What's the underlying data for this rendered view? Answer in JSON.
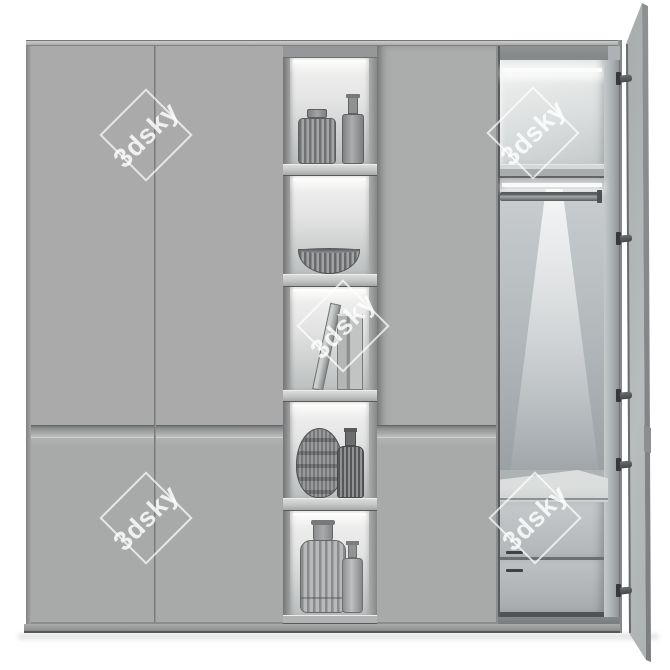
{
  "watermarks": [
    {
      "text": "3dsky",
      "cx": 146,
      "cy": 135
    },
    {
      "text": "3dsky",
      "cx": 533,
      "cy": 133
    },
    {
      "text": "3dsky",
      "cx": 343,
      "cy": 326
    },
    {
      "text": "3dsky",
      "cx": 146,
      "cy": 518
    },
    {
      "text": "3dsky",
      "cx": 535,
      "cy": 518
    }
  ],
  "colors": {
    "background": "#ffffff",
    "door_grey": "#a9aaa9",
    "frame_grey": "#8f9091",
    "niche_highlight": "#f1f1f0",
    "interior_grey": "#b6bbbe",
    "dark_edge": "#57595a",
    "led_white": "#fcfcfb",
    "watermark_white": "rgba(255,255,255,0.8)"
  },
  "scene": {
    "type": "3d-render-preview",
    "subject": "grey wardrobe with open display shelves and open hinged door",
    "left_side": [
      "two plain door panels",
      "horizontal handle groove",
      "base plinth"
    ],
    "shelf_column_objects": [
      "ribbed jar with lid and bottle",
      "ribbed bowl",
      "leaning book and standing books",
      "striped round vase and ribbed bottle",
      "large ribbed bottle and small bottle"
    ],
    "right_open_section": [
      "led strip light",
      "top shelf compartment",
      "hanging rod with light glow",
      "countertop",
      "drawer unit with two drawers and bar handles",
      "open hinged door with five hinges"
    ]
  }
}
